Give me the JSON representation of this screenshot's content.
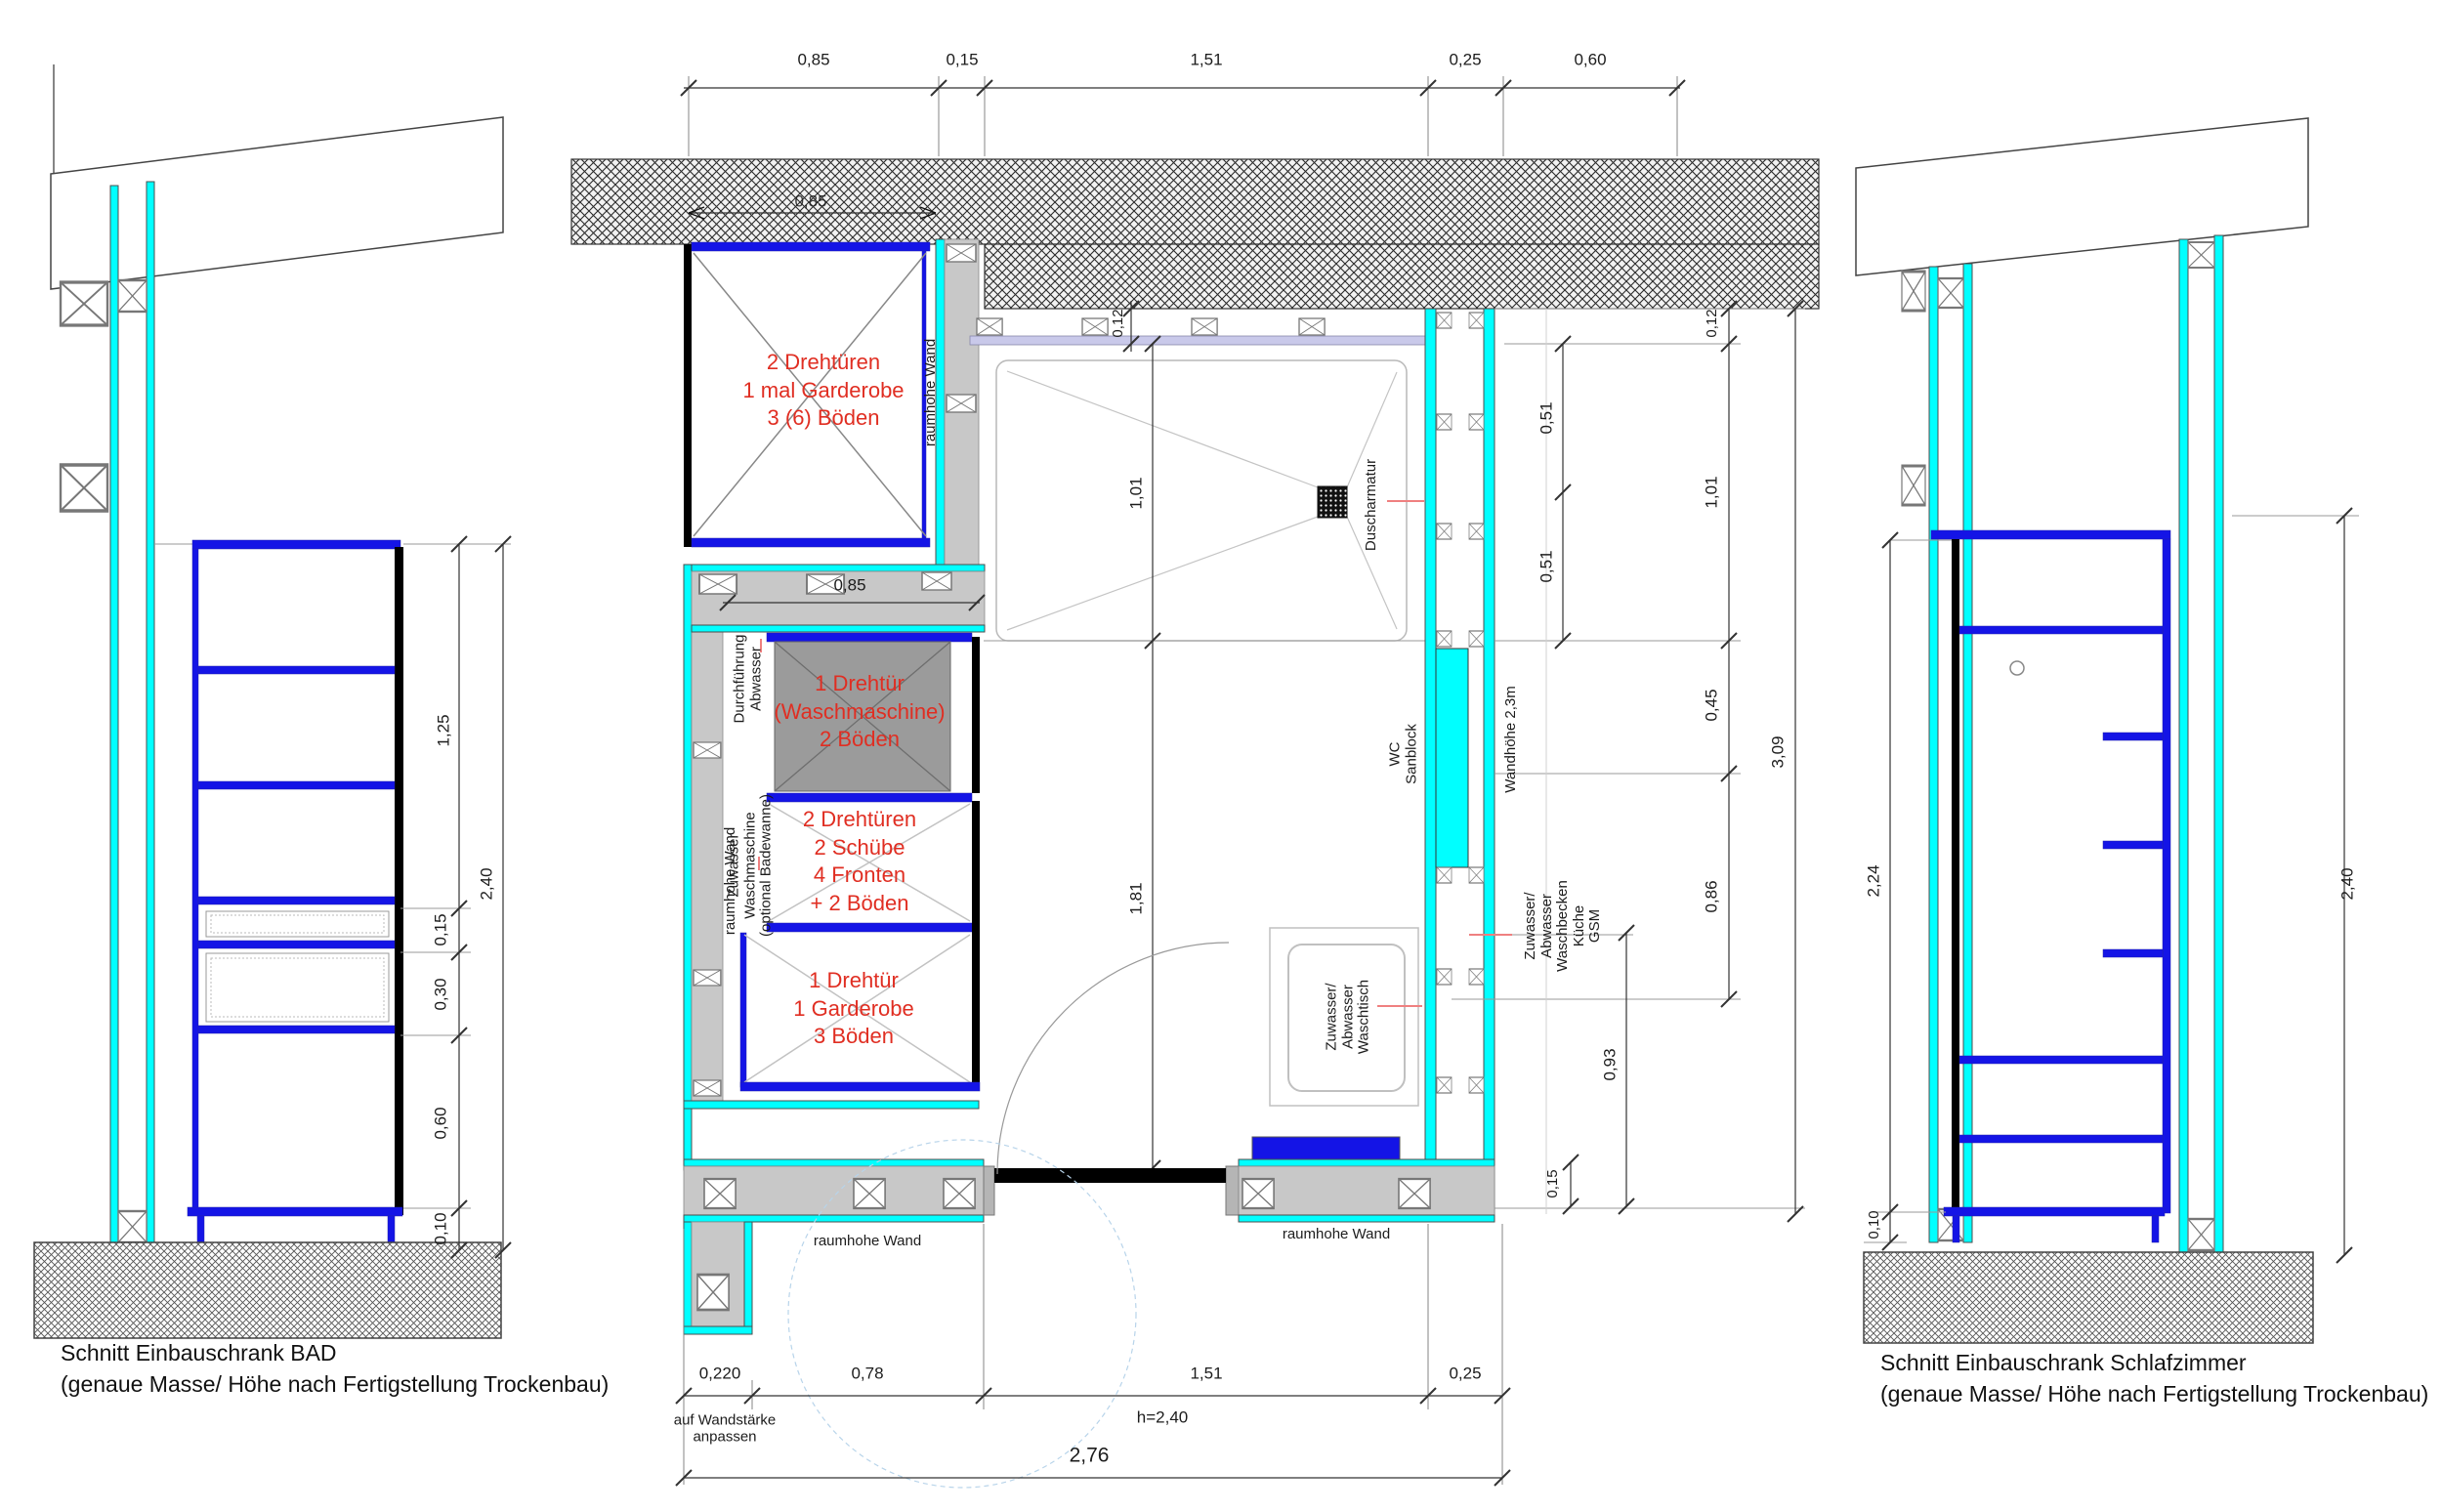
{
  "drawing": {
    "left_section": {
      "caption": [
        "Schnitt Einbauschrank BAD",
        "(genaue Masse/ Höhe nach Fertigstellung Trockenbau)"
      ],
      "dims": {
        "seg1": "1,25",
        "seg2": "0,15",
        "seg3": "0,30",
        "seg4": "0,60",
        "seg5": "0,10",
        "total": "2,40"
      }
    },
    "plan": {
      "top_dims": [
        "0,85",
        "0,15",
        "1,51",
        "0,25",
        "0,60"
      ],
      "wall_hidden_dim": "0,85",
      "closet_width_dim": "0,85",
      "closet_top_lines": [
        "2 Drehtüren",
        "1 mal Garderobe",
        "3 (6) Böden"
      ],
      "washer_lines": [
        "1 Drehtür",
        "(Waschmaschine)",
        "2 Böden"
      ],
      "dresser_lines": [
        "2 Drehtüren",
        "2 Schübe",
        "4 Fronten",
        "+ 2 Böden"
      ],
      "wardrobe_lines": [
        "1 Drehtür",
        "1 Garderobe",
        "3 Böden"
      ],
      "labels": {
        "raumhohe_wand": "raumhohe Wand",
        "durchfuehrung": [
          "Durchführung",
          "Abwasser"
        ],
        "zuwasser_wm": [
          "Zuwasser",
          "Waschmaschine",
          "(optional Badewanne)"
        ],
        "duscharmatur": "Duscharmatur",
        "wc_sanblock": [
          "WC",
          "Sanblock"
        ],
        "wandhoehe": "Wandhöhe 2,3m",
        "zuwasser_kueche": [
          "Zuwasser/",
          "Abwasser",
          "Waschbecken",
          "Küche",
          "GSM"
        ],
        "waschtisch": [
          "Zuwasser/",
          "Abwasser",
          "Waschtisch"
        ],
        "note": [
          "auf Wandstärke",
          "anpassen"
        ]
      },
      "left_v_dims": {
        "d012": "0,12",
        "d101": "1,01",
        "d181": "1,81"
      },
      "right_v_dims": {
        "d012": "0,12",
        "d051a": "0,51",
        "d051b": "0,51",
        "d101": "1,01",
        "d045": "0,45",
        "d086": "0,86",
        "d093": "0,93",
        "d015": "0,15",
        "total": "3,09"
      },
      "bottom_dims": [
        "0,220",
        "0,78",
        "1,51",
        "0,25"
      ],
      "door_height": "h=2,40",
      "total_width": "2,76"
    },
    "right_section": {
      "caption": [
        "Schnitt Einbauschrank Schlafzimmer",
        "(genaue Masse/ Höhe nach Fertigstellung Trockenbau)"
      ],
      "dims": {
        "height": "2,24",
        "base": "0,10",
        "total": "2,40"
      }
    }
  }
}
